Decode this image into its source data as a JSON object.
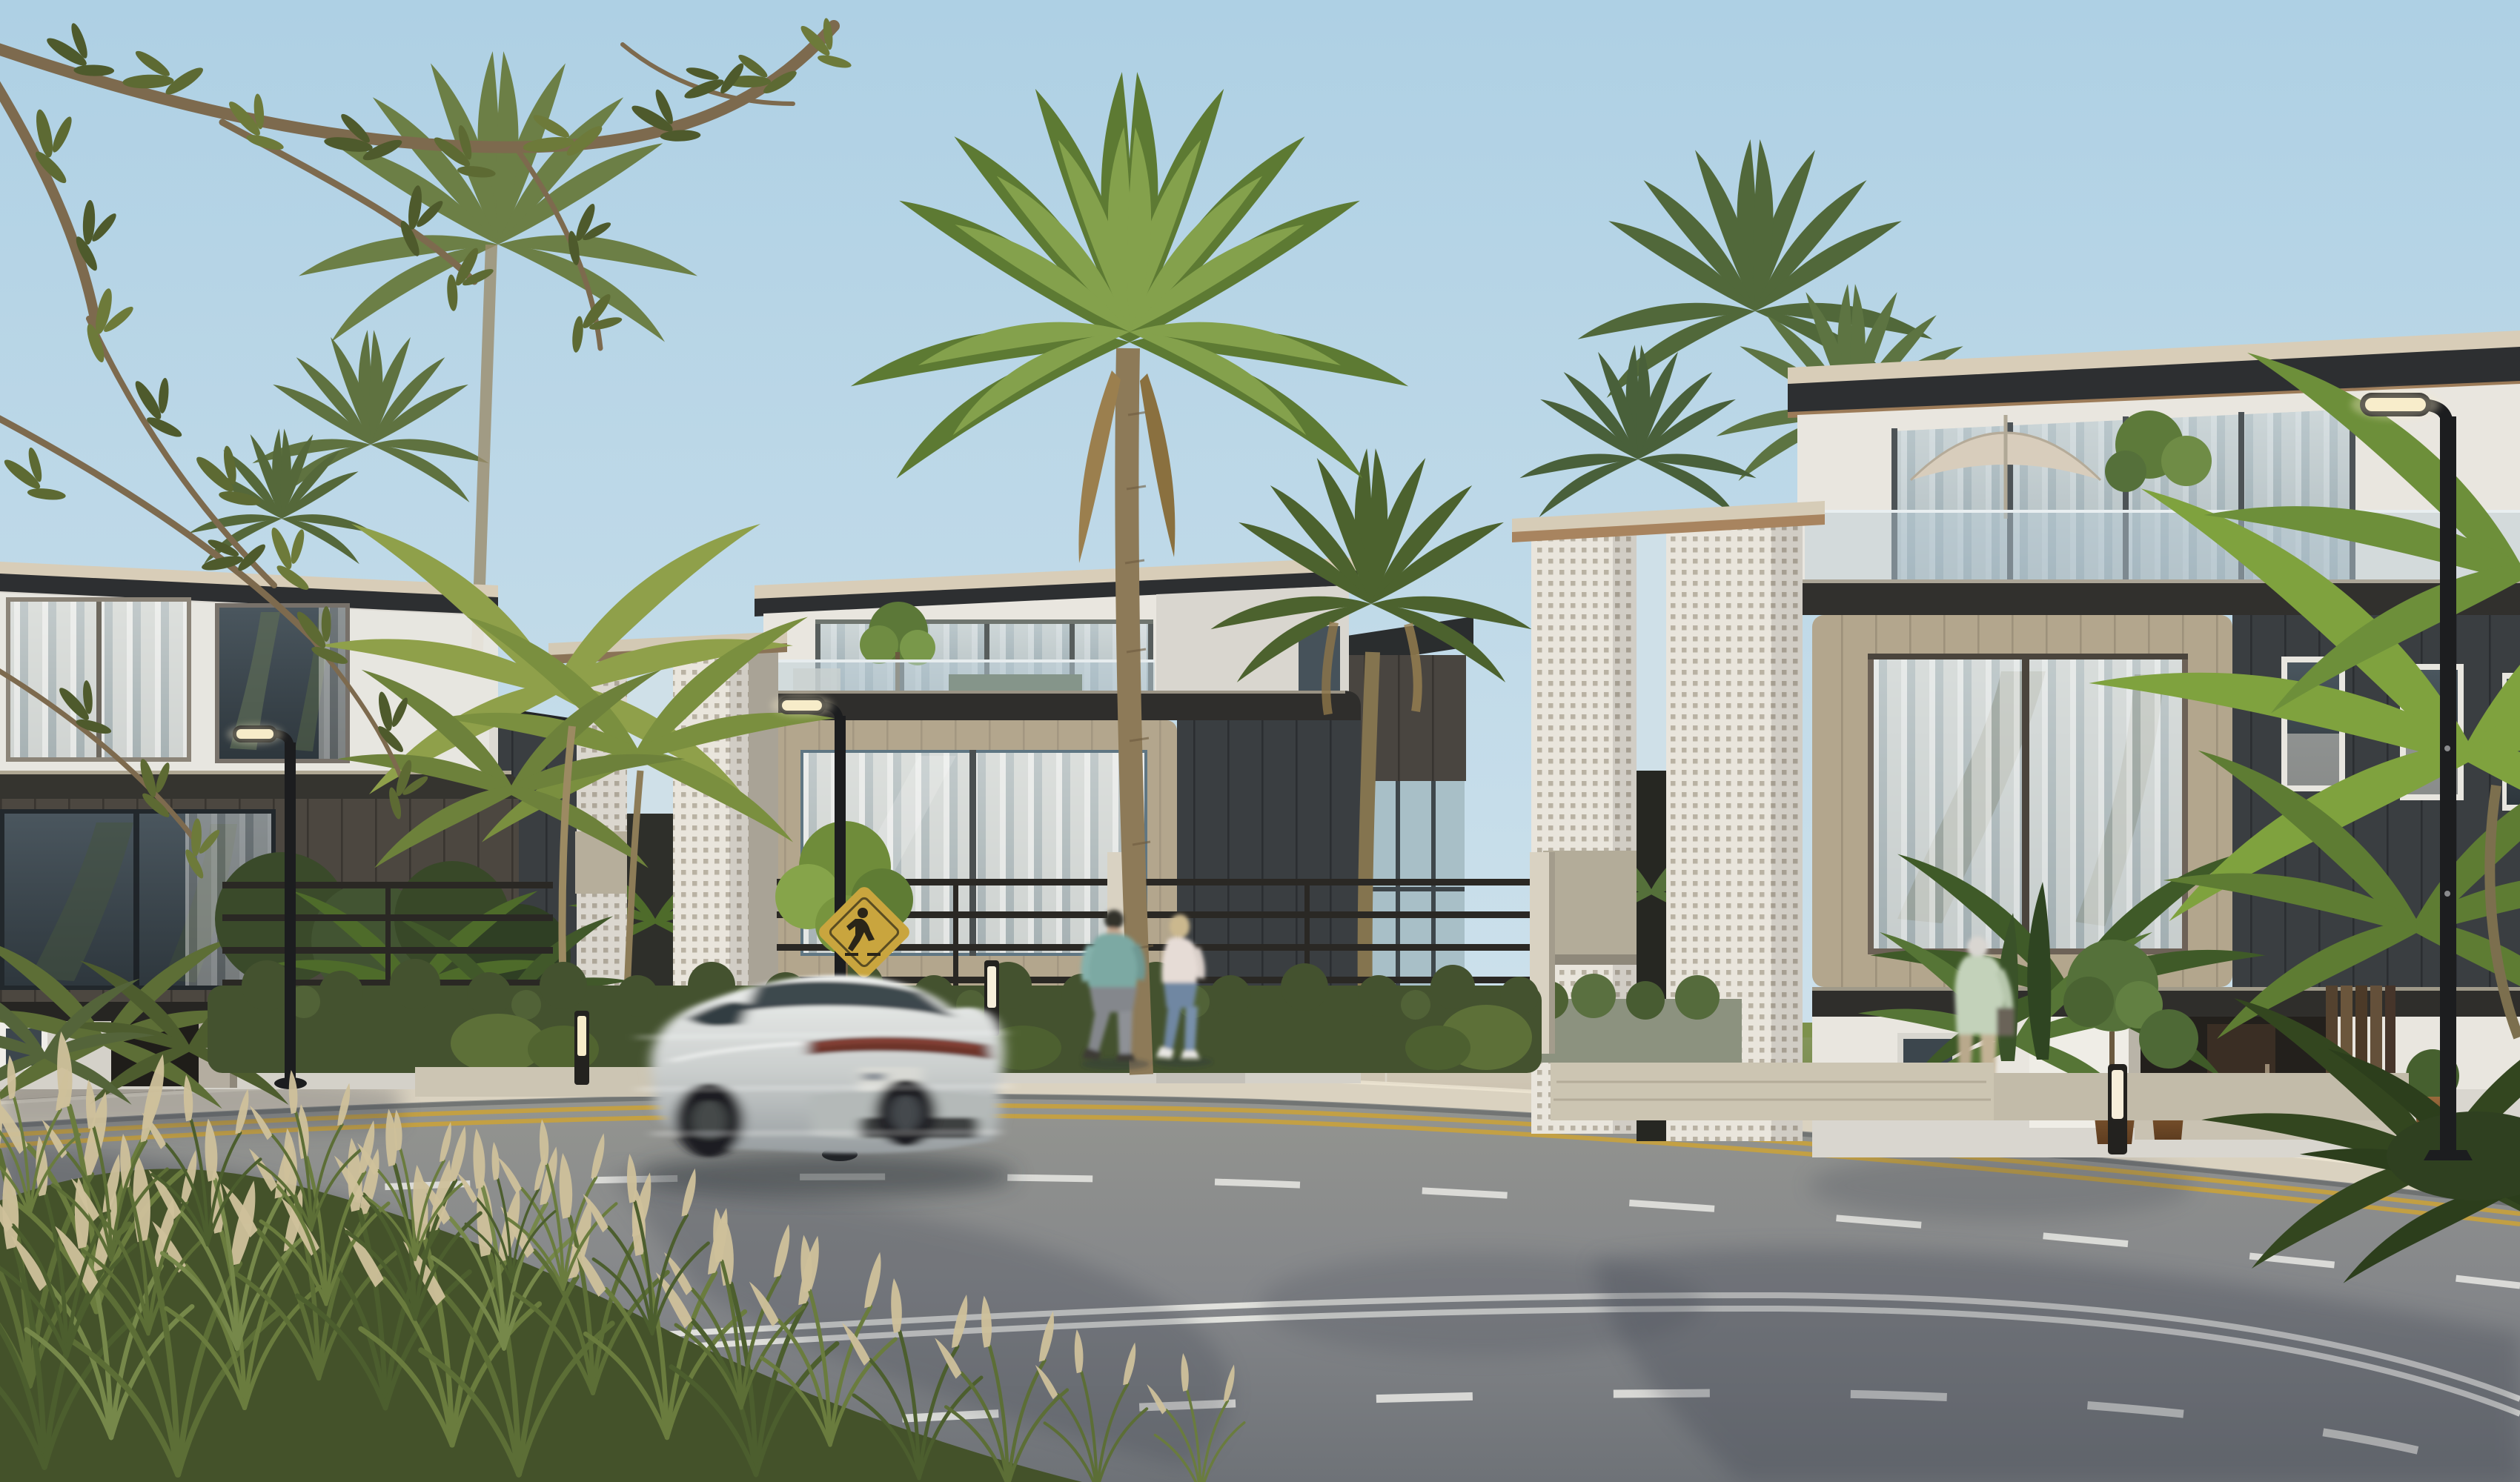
{
  "scene": {
    "description": "Photorealistic architectural rendering of a sunny coastal residential street: three modern white villas with dark timber-clad volumes and white perforated breeze-block towers, palm trees, a motion-blurred silver sedan passing on the curved road, two pedestrians on the sidewalk and a resident at an entrance",
    "sky": "clear pale blue",
    "lighting": "warm low sun from the left"
  },
  "palette": {
    "sky_top": "#aed0e4",
    "sky_horizon": "#e3eef2",
    "foliage_dark": "#46552c",
    "foliage_mid": "#5d6e36",
    "foliage_light": "#7e9447",
    "palm_frond": "#5d7a33",
    "palm_frond_light": "#84a14c",
    "palm_frond_muted": "#6c7f46",
    "palm_trunk": "#8d7a58",
    "areca_green": "#8fa04a",
    "stucco": "#e9e6df",
    "stucco_shade": "#d4d1c9",
    "clad_brown": "#4c4740",
    "clad_charcoal": "#3a3e41",
    "wood_frame": "#b3a68d",
    "roof_edge": "#d8cdb8",
    "fascia_dark": "#2d2f31",
    "breeze_block": "#e9e5dc",
    "concrete_pier": "#a9a396",
    "glass_sky": "#a9c0cb",
    "glass_dark": "#424e56",
    "curtain": "#e9e6e0",
    "fence_dark": "#2a2824",
    "hedge": "#44522f",
    "lawn": "#7d914c",
    "flower_yellow": "#d8c84a",
    "sidewalk": "#c8bfad",
    "curb": "#dad2c0",
    "road": "#8e8f8b",
    "road_shadow": "#3c4350",
    "lane_white": "#e9e9e4",
    "lane_yellow": "#c9a23c",
    "car_silver": "#c7cbc9",
    "taillight": "#6e352c",
    "lamp_black": "#1c1d1f",
    "lamp_glow": "#f7ecc9",
    "sign_yellow": "#c9a53e",
    "shirt_teal": "#7ca9a3",
    "jeans": "#6f87a2",
    "top_white": "#e6dcd6",
    "shirt_sage": "#c3d2ba",
    "plume_tan": "#cdbf9a",
    "pot_bronze": "#8a5f36",
    "branch_brown": "#7d6a4e"
  },
  "objects": {
    "buildings": [
      {
        "label": "villa-left",
        "features": [
          "white top floor with curtained glazing",
          "dark timber-shingle middle floor with picture window",
          "recessed entry with grey pier",
          "charcoal rear wing"
        ]
      },
      {
        "label": "villa-middle",
        "features": [
          "white perforated breeze-block tower",
          "roof terrace with glass balustrade and small tree",
          "light timber-framed window box with sheer curtains",
          "charcoal side cladding"
        ]
      },
      {
        "label": "villa-right",
        "features": [
          "double perforated breeze-block screens",
          "roof terrace with parasol and planting",
          "dark timber window box with curtains",
          "charcoal wing with three small windows",
          "recessed entry with timber fins and potted topiary"
        ]
      },
      {
        "label": "distant-glass-house",
        "features": [
          "charcoal roof",
          "glazed curtain wall"
        ]
      }
    ],
    "vehicle": {
      "label": "silver-sedan",
      "state": "motion-blurred, travelling left",
      "details": [
        "red-brown tail-light band",
        "licence plate",
        "dark blurred wheels"
      ]
    },
    "people": [
      {
        "label": "man-teal-shirt",
        "state": "walking right on sidewalk"
      },
      {
        "label": "woman-pink-top",
        "state": "walking right beside him"
      },
      {
        "label": "man-at-entrance",
        "state": "blurred, walking on villa-right path"
      }
    ],
    "street_furniture": [
      "street-lamp-left",
      "street-lamp-middle",
      "street-lamp-right",
      "light-bollard x3",
      "pedestrian-crossing-sign"
    ],
    "road_markings": [
      "double-yellow edge line along curb",
      "dashed white lane lines",
      "double solid white centre line"
    ],
    "vegetation": [
      "overhanging olive branches top-left",
      "royal palm crowns",
      "tall twin palm mid-scene",
      "areca palm clusters",
      "clipped hedges behind rail fence",
      "lawn with yellow wildflowers",
      "foreground ornamental grass with tan plumes",
      "potted topiary trees"
    ]
  }
}
